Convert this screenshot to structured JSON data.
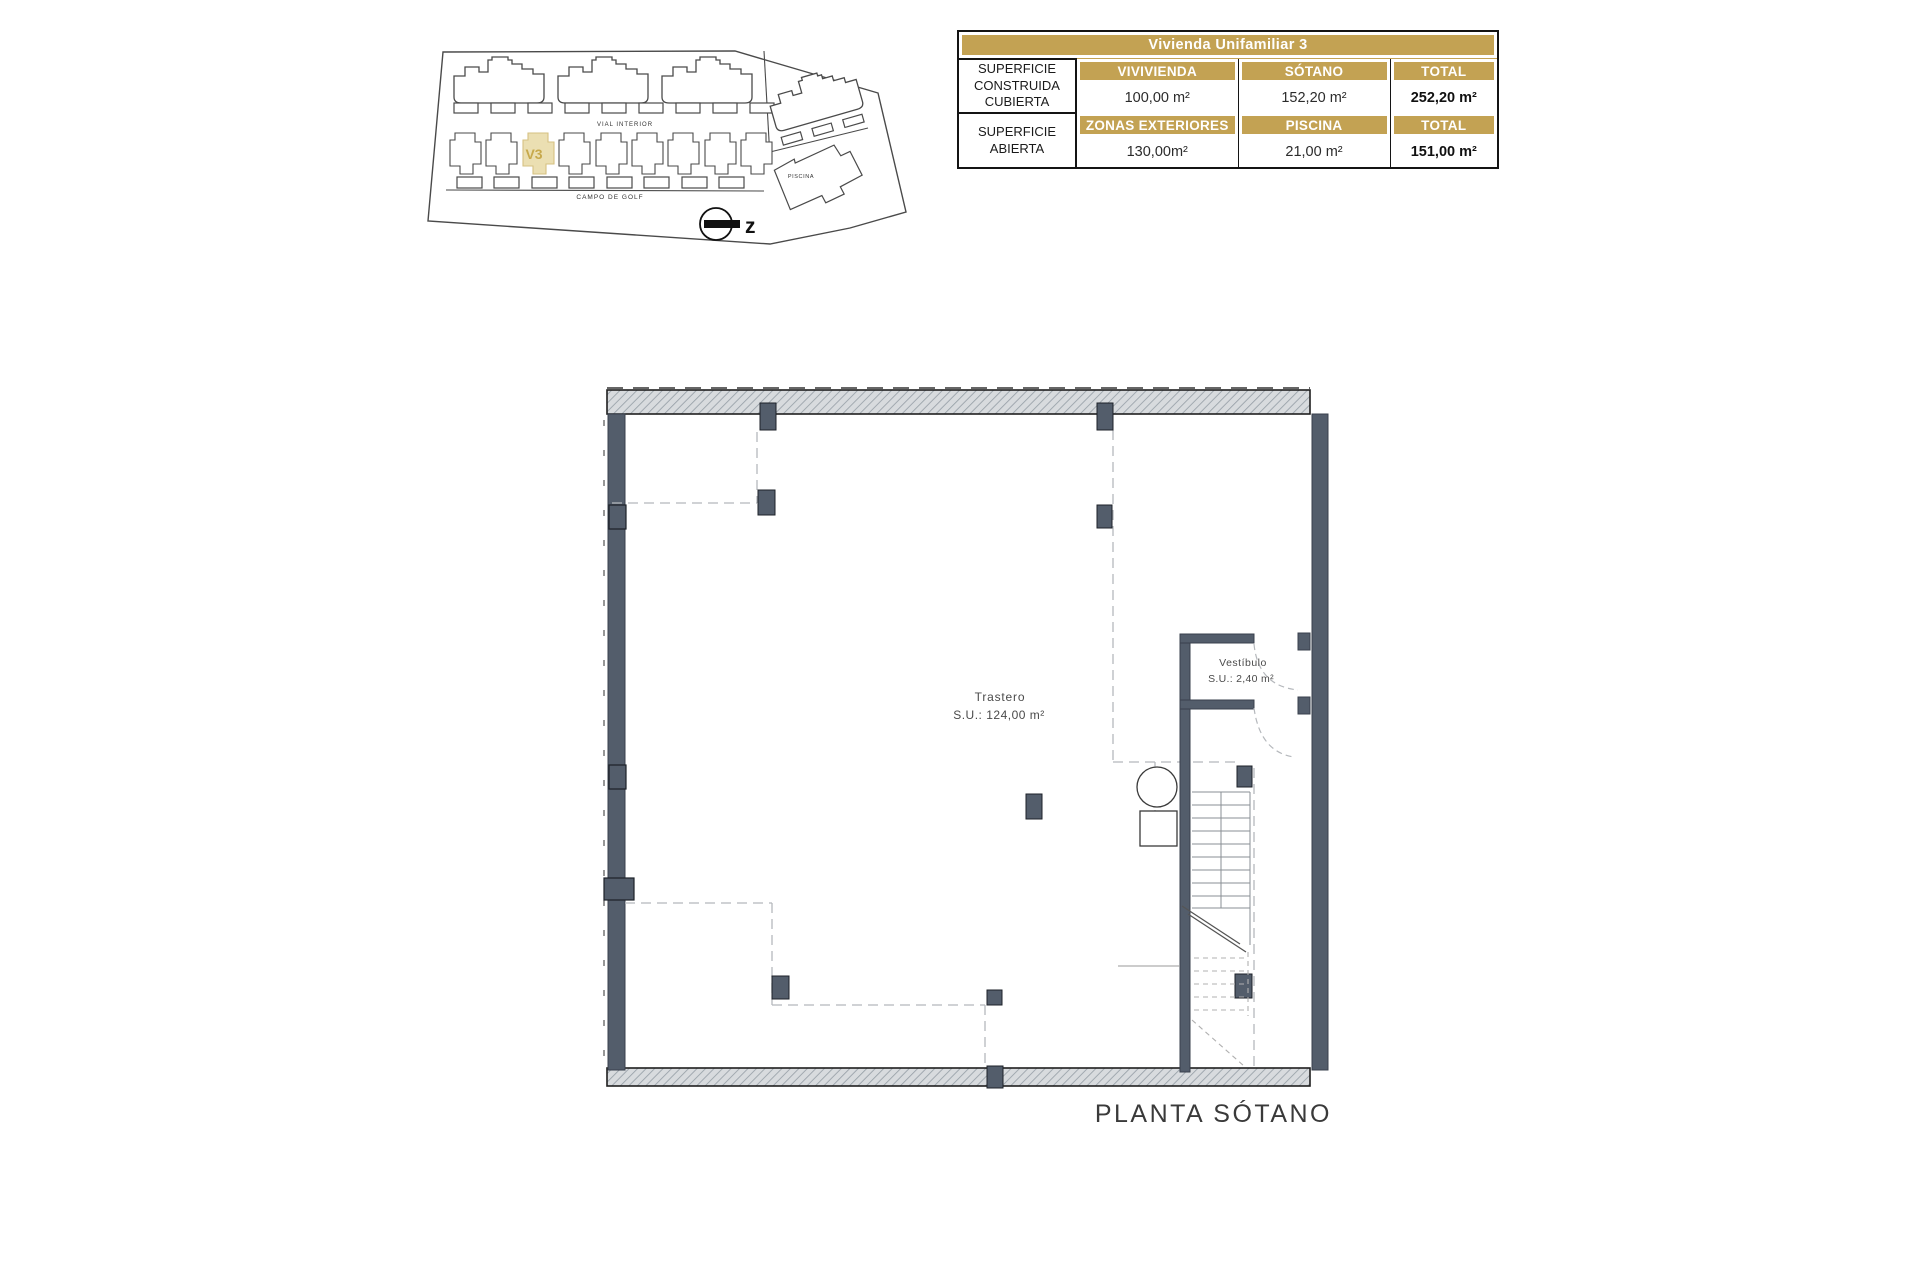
{
  "colors": {
    "gold": "#C3A253",
    "tan_highlight": "#EBDFB2",
    "wall_gray": "#535D6B",
    "hatch_gray": "#D8DBDE"
  },
  "site_plan": {
    "unit_label": "V3",
    "road_label": "VIAL INTERIOR",
    "golf_label": "CAMPO DE GOLF",
    "pool_label": "PISCINA",
    "north_label": "z"
  },
  "summary_table": {
    "title": "Vivienda Unifamiliar 3",
    "sections": [
      {
        "row_label": "SUPERFICIE CONSTRUIDA CUBIERTA",
        "columns": [
          "VIVIVIENDA",
          "SÓTANO",
          "TOTAL"
        ],
        "values": [
          "100,00 m²",
          "152,20 m²",
          "252,20 m²"
        ]
      },
      {
        "row_label": "SUPERFICIE ABIERTA",
        "columns": [
          "ZONAS EXTERIORES",
          "PISCINA",
          "TOTAL"
        ],
        "values": [
          "130,00m²",
          "21,00 m²",
          "151,00 m²"
        ]
      }
    ]
  },
  "floor_plan": {
    "rooms": [
      {
        "name": "Trastero",
        "area": "S.U.: 124,00 m²"
      },
      {
        "name": "Vestíbulo",
        "area": "S.U.: 2,40 m²"
      }
    ],
    "caption": "PLANTA SÓTANO"
  }
}
